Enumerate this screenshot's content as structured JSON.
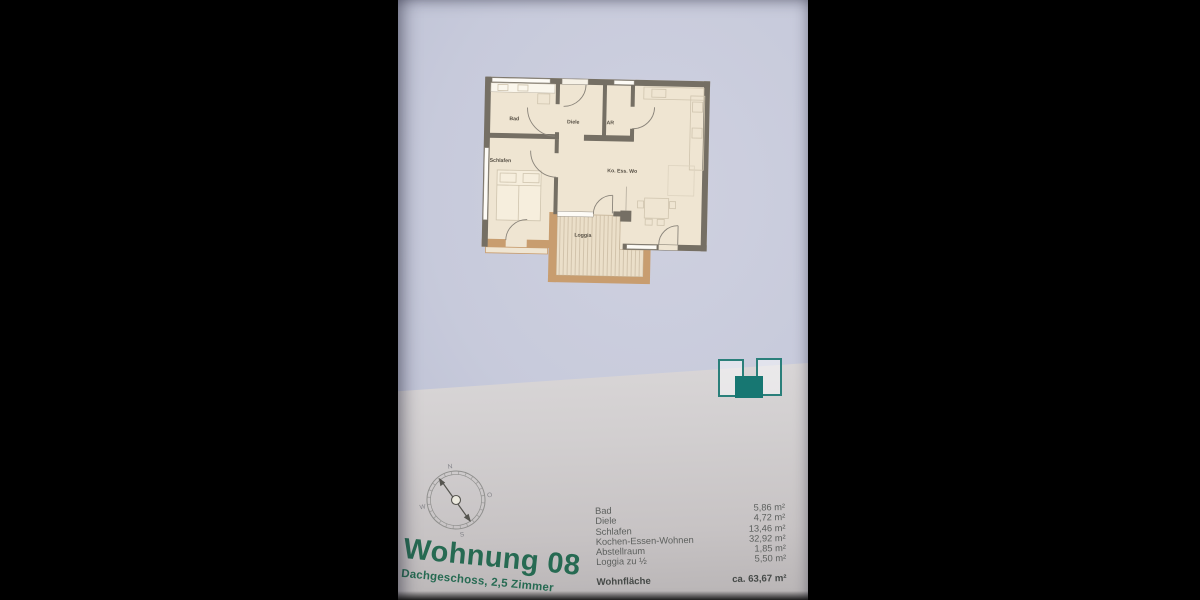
{
  "page": {
    "title": "Wohnung 08",
    "subtitle": "Dachgeschoss, 2,5 Zimmer"
  },
  "floorplan": {
    "rooms": [
      {
        "label": "Bad"
      },
      {
        "label": "Diele"
      },
      {
        "label": "AR"
      },
      {
        "label": "Schlafen"
      },
      {
        "label": "Ko. Ess. Wo"
      },
      {
        "label": "Loggia"
      }
    ]
  },
  "compass": {
    "north": "N",
    "east": "O",
    "south": "S",
    "west": "W"
  },
  "area_table": {
    "rows": [
      {
        "label": "Bad",
        "value": "5,86 m²"
      },
      {
        "label": "Diele",
        "value": "4,72 m²"
      },
      {
        "label": "Schlafen",
        "value": "13,46 m²"
      },
      {
        "label": "Kochen-Essen-Wohnen",
        "value": "32,92 m²"
      },
      {
        "label": "Abstellraum",
        "value": "1,85 m²"
      },
      {
        "label": "Loggia zu ½",
        "value": "5,50 m²"
      }
    ],
    "total_label": "Wohnfläche",
    "total_value": "ca. 63,67 m²"
  },
  "colors": {
    "accent_teal": "#177772",
    "title_green": "#266a52",
    "wall_dark": "#756f64",
    "wall_tan": "#c89d6f",
    "floor_cream": "#efe5d2"
  }
}
